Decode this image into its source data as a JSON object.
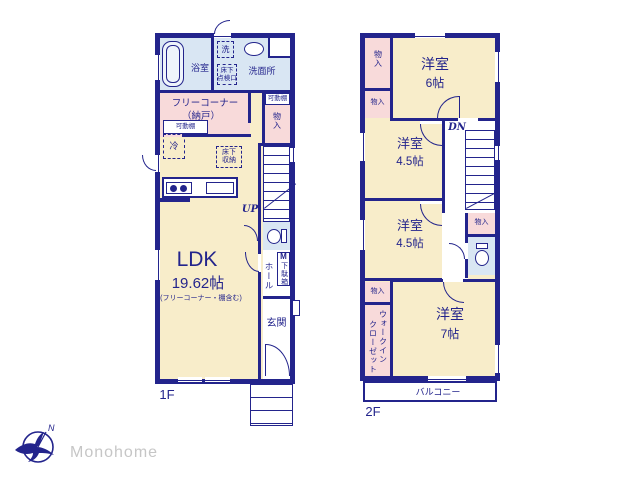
{
  "floor1": {
    "label": "1F",
    "rooms": {
      "bath": "浴室",
      "washer": "洗",
      "washroom": "洗面所",
      "underfloor_access": [
        "床下",
        "点検口"
      ],
      "free_corner": [
        "フリーコーナー",
        "（納戸）"
      ],
      "movable_shelf_right": "可動棚",
      "movable_shelf_left": "可動棚",
      "storage_right": "物入",
      "fridge": "冷",
      "underfloor_storage": [
        "床下",
        "収納"
      ],
      "ldk": {
        "name": "LDK",
        "size": "19.62帖",
        "note": "(フリーコーナー・棚含む)"
      },
      "hall": "ホール",
      "shoe_cabinet": {
        "prefix": "M",
        "name": "下駄箱"
      },
      "entrance": "玄関"
    },
    "stairs_up": "UP"
  },
  "floor2": {
    "label": "2F",
    "rooms": {
      "storage_a": "物入",
      "storage_b": "物入",
      "room6": {
        "name": "洋室",
        "size": "6帖"
      },
      "room45a": {
        "name": "洋室",
        "size": "4.5帖"
      },
      "room45b": {
        "name": "洋室",
        "size": "4.5帖"
      },
      "room7": {
        "name": "洋室",
        "size": "7帖"
      },
      "storage_c": "物入",
      "storage_d": "物入",
      "wic": [
        "ウォークイン",
        "クローゼット"
      ],
      "balcony": "バルコニー"
    },
    "stairs_down": "DN"
  },
  "logo": {
    "brand": "Monohome",
    "compass_north": "N"
  },
  "colors": {
    "wall": "#23248c",
    "room_cream": "#f8edca",
    "room_pink": "#f8dada",
    "room_blue": "#d9e6f3",
    "logo_text": "#c6c6c6"
  }
}
